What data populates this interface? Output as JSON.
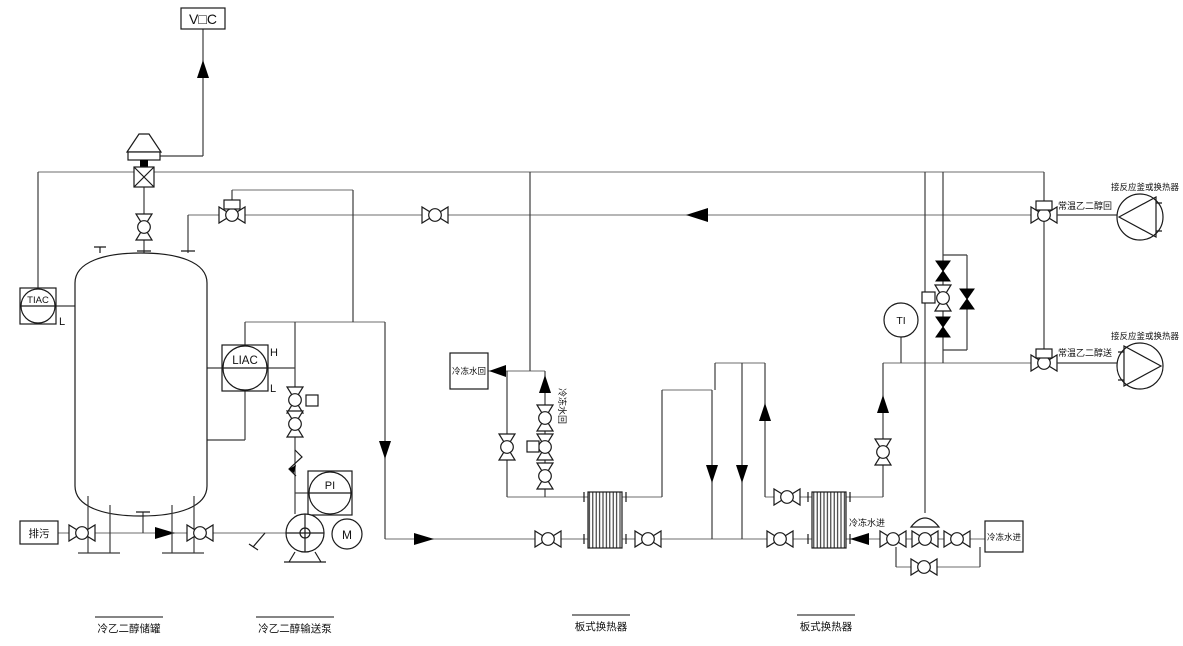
{
  "labels": {
    "vent": "V□C",
    "drain": "排污",
    "chilled_return_box": "冷冻水回",
    "chilled_return_line": "冷冻水回",
    "chilled_supply_box": "冷冻水进",
    "chilled_supply_line": "冷冻水进",
    "glycol_return_line": "常温乙二醇回",
    "glycol_supply_line": "常温乙二醇送",
    "dest_top": "接反应釜或换热器",
    "dest_bottom": "接反应釜或换热器"
  },
  "instruments": {
    "tiac": {
      "tag": "TIAC",
      "low": "L"
    },
    "liac": {
      "tag": "LIAC",
      "high": "H",
      "low": "L"
    },
    "pi": {
      "tag": "PI"
    },
    "motor": {
      "tag": "M"
    },
    "ti": {
      "tag": "TI"
    }
  },
  "equipment": {
    "tank": "冷乙二醇储罐",
    "pump": "冷乙二醇输送泵",
    "hx1": "板式换热器",
    "hx2": "板式换热器"
  },
  "colors": {
    "pipe": "#8a8a8a",
    "symbol": "#1a1a1a",
    "arrow": "#000000",
    "bg": "#ffffff"
  }
}
